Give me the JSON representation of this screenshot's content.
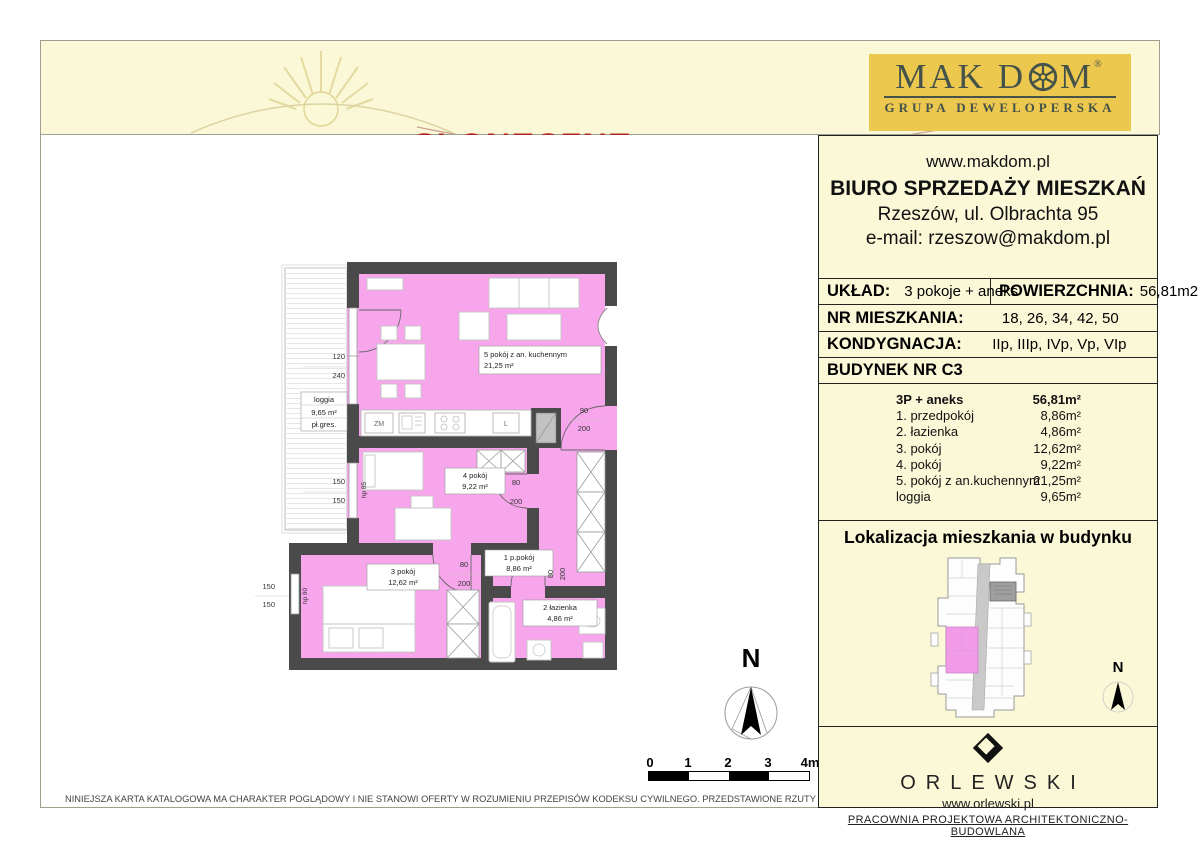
{
  "header": {
    "estate_prefix": "Osiedle",
    "estate_name": "SŁONECZNE"
  },
  "brand": {
    "name_pre": "MAK D",
    "name_post": "M",
    "registered": "®",
    "tagline": "GRUPA DEWELOPERSKA"
  },
  "contact": {
    "website": "www.makdom.pl",
    "office": "BIURO SPRZEDAŻY MIESZKAŃ",
    "address": "Rzeszów, ul. Olbrachta 95",
    "email": "e-mail: rzeszow@makdom.pl"
  },
  "specs": {
    "layout_label": "UKŁAD:",
    "layout_value": "3 pokoje + aneks",
    "area_label": "POWIERZCHNIA:",
    "area_value": "56,81m2",
    "apartment_no_label": "NR MIESZKANIA:",
    "apartment_no_value": "18, 26, 34, 42, 50",
    "floor_label": "KONDYGNACJA:",
    "floor_value": "IIp, IIIp, IVp, Vp, VIp",
    "building_label": "BUDYNEK NR C3"
  },
  "room_table": {
    "header": {
      "name": "3P + aneks",
      "area": "56,81m²"
    },
    "rows": [
      {
        "name": "1. przedpokój",
        "area": "8,86m²"
      },
      {
        "name": "2. łazienka",
        "area": "4,86m²"
      },
      {
        "name": "3. pokój",
        "area": "12,62m²"
      },
      {
        "name": "4. pokój",
        "area": "9,22m²"
      },
      {
        "name": "5. pokój z an.kuchennym",
        "area": "21,25m²"
      },
      {
        "name": "loggia",
        "area": "9,65m²"
      }
    ]
  },
  "localization": {
    "title": "Lokalizacja mieszkania w budynku",
    "compass": "N"
  },
  "architect": {
    "name": "ORLEWSKI",
    "website": "www.orlewski.pl",
    "tagline": "PRACOWNIA PROJEKTOWA ARCHITEKTONICZNO-BUDOWLANA"
  },
  "plan": {
    "room5": {
      "name": "5 pokój z an. kuchennym",
      "area": "21,25 m²"
    },
    "room4": {
      "name": "4 pokój",
      "area": "9,22 m²"
    },
    "room3": {
      "name": "3 pokój",
      "area": "12,62 m²"
    },
    "room1": {
      "name": "1  p.pokój",
      "area": "8,86 m²"
    },
    "room2": {
      "name": "2 łazienka",
      "area": "4,86 m²"
    },
    "loggia": {
      "name": "loggia",
      "area": "9,65 m²",
      "floor": "pł.gres."
    },
    "kitchen": {
      "washer": "ZM",
      "fridge": "L"
    },
    "dims": {
      "balcony_w": "120",
      "balcony_h": "240",
      "win_room4_a": "150",
      "win_room4_b": "150",
      "win_room3_a": "150",
      "win_room3_b": "150",
      "entry_w": "90",
      "entry_h": "200",
      "door4_w": "80",
      "door4_h": "200",
      "door3_w": "80",
      "door3_h": "200",
      "door2_w": "80",
      "door2_h": "200",
      "hp_room4": "hp 85",
      "hp_room3": "hp 90"
    },
    "compass": "N"
  },
  "scalebar": {
    "t0": "0",
    "t1": "1",
    "t2": "2",
    "t3": "3",
    "t4": "4m"
  },
  "disclaimer": "NINIEJSZA KARTA KATALOGOWA MA CHARAKTER POGLĄDOWY I NIE STANOWI OFERTY W ROZUMIENIU PRZEPISÓW KODEKSU CYWILNEGO. PRZEDSTAWIONE RZUTY I POWIERZCHNIE MOGĄ ULEC ZMIANIE",
  "colors": {
    "cream": "#FBF8D8",
    "accent_red": "#A82A2A",
    "gold": "#EDC84F",
    "brand_ink": "#44524A",
    "pink": "#F7A6EC",
    "wall": "#4A4A4A"
  }
}
